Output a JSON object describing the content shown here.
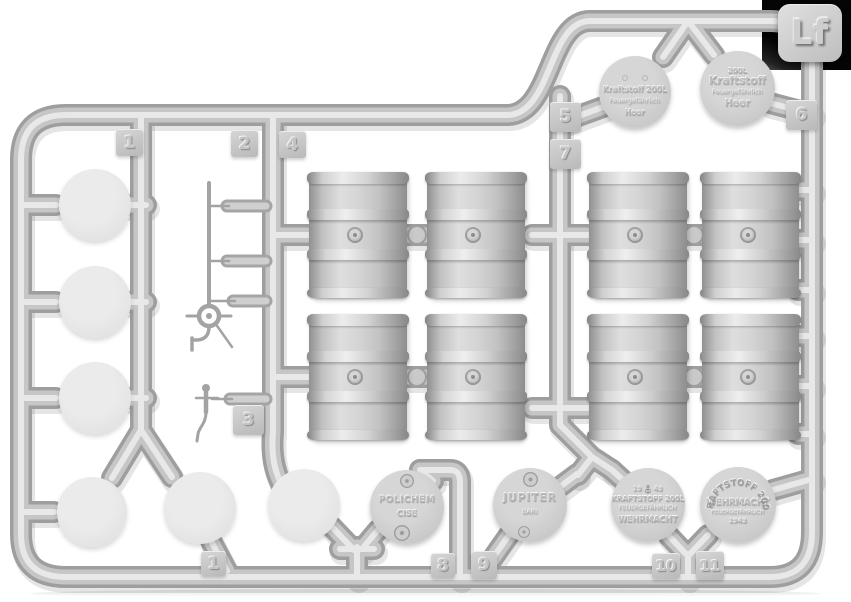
{
  "plate": {
    "code": "Lf"
  },
  "part_tags": {
    "tag1_top": "1",
    "tag2": "2",
    "tag4": "4",
    "tag5": "5",
    "tag7": "7",
    "tag6": "6",
    "tag3": "3",
    "tag1_bottom": "1",
    "tag8": "8",
    "tag9": "9",
    "tag10": "10",
    "tag11": "11"
  },
  "lids": {
    "heer_small": {
      "line1": "Kraftstoff 200L",
      "line2": "Feuergefährlich",
      "line3": "Heer"
    },
    "heer_large": {
      "line0": "200L",
      "line1": "Kraftstoff",
      "line2": "Feuergefährlich",
      "line3": "Heer"
    },
    "polichem": {
      "line1": "POLICHEM",
      "line2": "CISE"
    },
    "jupiter": {
      "line1": "JUPITER",
      "line2": "BARI"
    },
    "kriegsmarine": {
      "year_left": "19",
      "year_right": "43",
      "line1": "KRAFTSTOFF 200L",
      "line2": "FEUERGEFÄHRLICH",
      "line3": "WEHRMACHT"
    },
    "wehrmacht": {
      "arc": "KRAFTSTOFF 200L",
      "line1": "WEHRMACHT",
      "line2": "FEUERGEFÄHRLICH",
      "line3": "1943"
    }
  },
  "colors": {
    "plastic": "#c9c9c9",
    "runner_shadow": "#9e9e9e",
    "highlight": "#e8e8e8",
    "corner_backdrop": "#0a0a0a",
    "background": "#ffffff"
  }
}
